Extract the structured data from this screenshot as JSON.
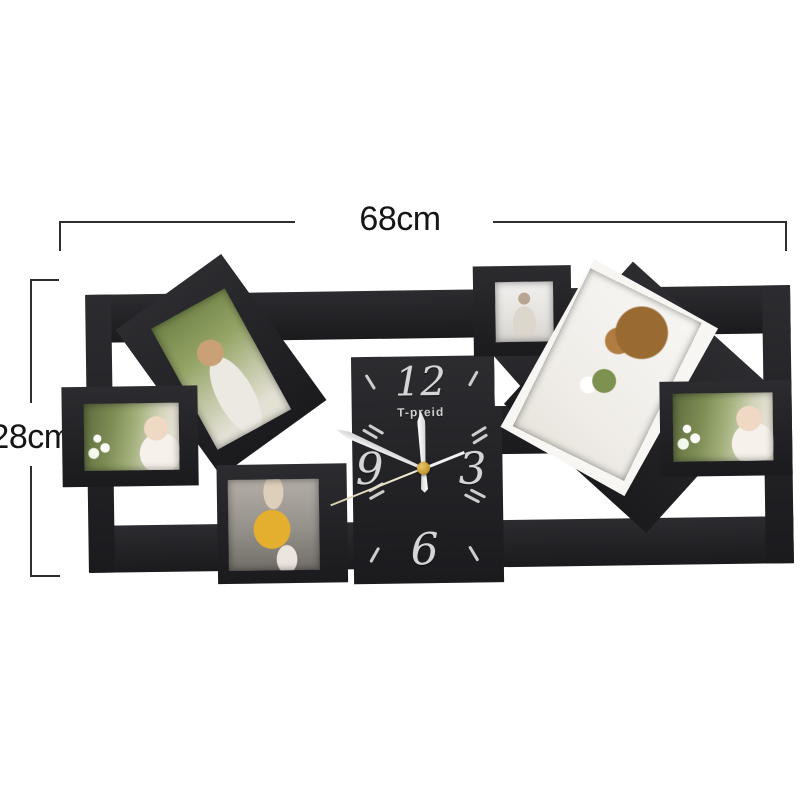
{
  "scene": {
    "background": "#ffffff",
    "description": "Product photo of a black wooden collage photo-frame wall clock annotated with its dimensions"
  },
  "annotations": {
    "width_label": "68cm",
    "height_label": "28cm",
    "line_color": "#2e2e2e",
    "label_color": "#161616"
  },
  "clock": {
    "brand": "T-preid",
    "numeral_12": "12",
    "numeral_3": "3",
    "numeral_6": "6",
    "numeral_9": "9",
    "frame_color": "#1f1f23",
    "numeral_color": "#d5d5d5",
    "hand_color": "#ededed",
    "second_hand_color": "#e6dfc8",
    "center_cap_color": "#c49a33",
    "time_approx": "11:48:38"
  },
  "photos": [
    {
      "id": "photo-left",
      "subject": "laughing baby with white flowers",
      "orientation": "landscape"
    },
    {
      "id": "photo-top-left",
      "subject": "girl blowing bubbles",
      "orientation": "portrait, tilted"
    },
    {
      "id": "photo-bottom",
      "subject": "toddler in yellow coat and hat",
      "orientation": "square"
    },
    {
      "id": "photo-small",
      "subject": "smiling young girl",
      "orientation": "square"
    },
    {
      "id": "photo-right-tilted",
      "subject": "overhead view of girl holding flowers",
      "orientation": "portrait, tilted"
    },
    {
      "id": "photo-right",
      "subject": "laughing baby with white flowers",
      "orientation": "landscape"
    }
  ]
}
